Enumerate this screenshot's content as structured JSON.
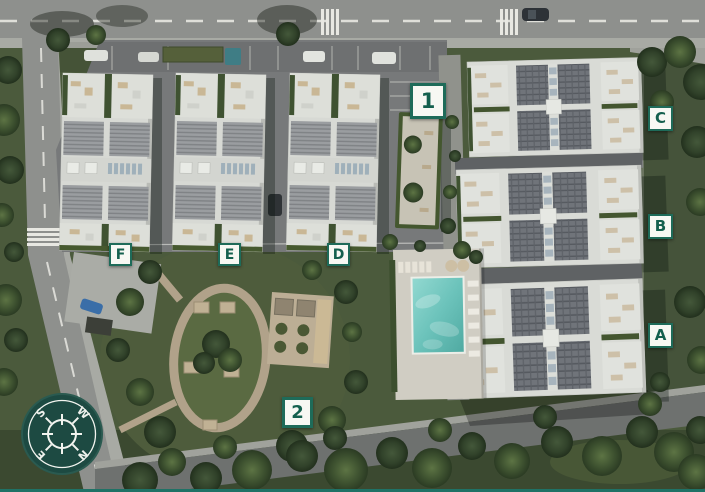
{
  "markers": [
    {
      "id": "building-1",
      "label": "1"
    },
    {
      "id": "area-2",
      "label": "2"
    },
    {
      "id": "block-c",
      "label": "C"
    },
    {
      "id": "block-b",
      "label": "B"
    },
    {
      "id": "block-a",
      "label": "A"
    },
    {
      "id": "block-f",
      "label": "F"
    },
    {
      "id": "block-e",
      "label": "E"
    },
    {
      "id": "block-d",
      "label": "D"
    }
  ],
  "compass": {
    "north": "N",
    "south": "S",
    "east": "E",
    "west": "W"
  },
  "colors": {
    "marker_border": "#1e6b59",
    "marker_text": "#14604e",
    "marker_background": "#f7f8f3",
    "compass_background": "#1d4a42",
    "pool_water": "#6cc3bb",
    "footer_line": "#1f7266"
  }
}
